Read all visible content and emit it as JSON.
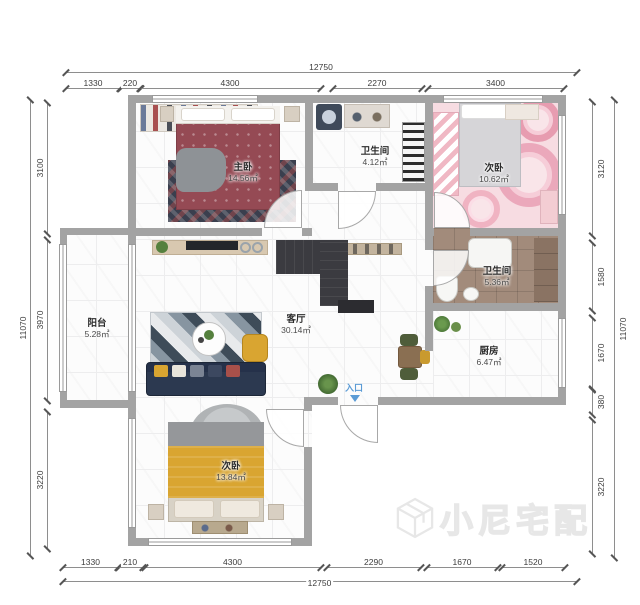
{
  "plan": {
    "entrance_label": "入口",
    "watermark": {
      "brand": "小尼宅配",
      "logo_icon": "cube-logo"
    },
    "rooms": [
      {
        "id": "master-bedroom",
        "name": "主卧",
        "area": "14.56㎡"
      },
      {
        "id": "bathroom-top",
        "name": "卫生间",
        "area": "4.12㎡"
      },
      {
        "id": "bedroom-right",
        "name": "次卧",
        "area": "10.62㎡"
      },
      {
        "id": "living-room",
        "name": "客厅",
        "area": "30.14㎡"
      },
      {
        "id": "balcony",
        "name": "阳台",
        "area": "5.28㎡"
      },
      {
        "id": "bathroom-middle",
        "name": "卫生间",
        "area": "5.36㎡"
      },
      {
        "id": "kitchen",
        "name": "厨房",
        "area": "6.47㎡"
      },
      {
        "id": "bedroom-bottom",
        "name": "次卧",
        "area": "13.84㎡"
      }
    ],
    "dimensions": {
      "top": {
        "total": "12750",
        "segments": [
          "1330",
          "220",
          "4300",
          "2270",
          "3400"
        ]
      },
      "bottom": {
        "total": "12750",
        "segments": [
          "1330",
          "210",
          "4300",
          "2290",
          "1670",
          "1520"
        ]
      },
      "left": {
        "total": "11070",
        "segments": [
          "3100",
          "3970",
          "3220"
        ]
      },
      "right": {
        "total": "11070",
        "segments": [
          "3120",
          "1580",
          "1670",
          "380",
          "3220"
        ]
      }
    },
    "colors": {
      "wall": "#a3a3a3",
      "entrance_blue": "#5b9bd5",
      "sofa_navy": "#2c3950",
      "accent_yellow": "#d9a531",
      "pink_floor": "#f7dce2",
      "brown_floor": "#a28b7b"
    }
  }
}
